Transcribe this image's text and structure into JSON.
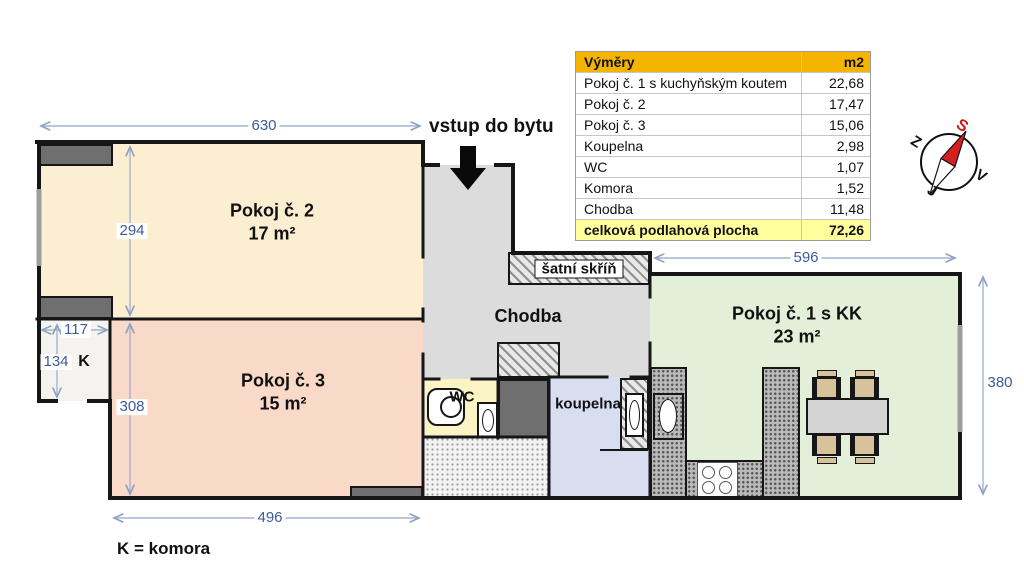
{
  "plan": {
    "entrance_label": "vstup do bytu",
    "legend": "K = komora",
    "rooms": {
      "pokoj2": {
        "name": "Pokoj č. 2",
        "area": "17 m²"
      },
      "pokoj3": {
        "name": "Pokoj č. 3",
        "area": "15 m²"
      },
      "pokoj1": {
        "name": "Pokoj č. 1 s KK",
        "area": "23 m²"
      },
      "chodba": {
        "name": "Chodba"
      },
      "wc": {
        "name": "WC"
      },
      "koupelna": {
        "name": "koupelna"
      },
      "satni_skrin": {
        "name": "šatní skříň"
      },
      "komora": {
        "name": "K"
      }
    },
    "dimensions": {
      "pokoj2_width": "630",
      "pokoj2_height": "294",
      "komora_width": "117",
      "komora_height": "134",
      "pokoj3_height": "308",
      "pokoj3_width": "496",
      "pokoj1_width": "596",
      "pokoj1_height": "380"
    }
  },
  "area_table": {
    "title": "Výměry",
    "unit": "m2",
    "rows": [
      {
        "name": "Pokoj č. 1 s kuchyňským koutem",
        "value": "22,68"
      },
      {
        "name": "Pokoj č. 2",
        "value": "17,47"
      },
      {
        "name": "Pokoj č. 3",
        "value": "15,06"
      },
      {
        "name": "Koupelna",
        "value": "2,98"
      },
      {
        "name": "WC",
        "value": "1,07"
      },
      {
        "name": "Komora",
        "value": "1,52"
      },
      {
        "name": "Chodba",
        "value": "11,48"
      }
    ],
    "total": {
      "name": "celková podlahová plocha",
      "value": "72,26"
    }
  },
  "compass": {
    "top": "S",
    "left": "Z",
    "right": "V",
    "bottom": "J"
  },
  "colors": {
    "pokoj2_fill": "#FBEED1",
    "pokoj3_fill": "#F9D9C7",
    "pokoj1_fill": "#E3EFD9",
    "chodba_fill": "#DCDCDC",
    "wc_fill": "#FAF3C4",
    "koupelna_fill": "#D8DEF0",
    "komora_fill": "#F4F3EF",
    "wall": "#161616",
    "dimension_blue": "#3D5A9E",
    "table_header_bg": "#F4B400",
    "table_total_bg": "#FFFF9E",
    "compass_needle_red": "#D42020"
  }
}
